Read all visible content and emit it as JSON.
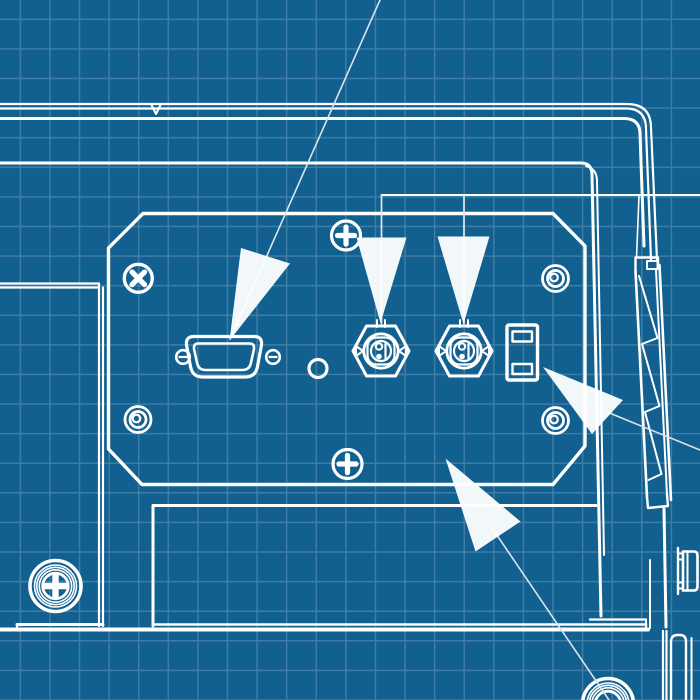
{
  "diagram": {
    "kind": "blueprint-rear-panel-drawing",
    "text_content": "",
    "callout_arrow_count": 5
  },
  "colors": {
    "background": "#11608F",
    "grid": "#3E7DA5",
    "line": "#FFFFFF",
    "arrow": "#FFFFFF",
    "callout": "#D9E4EC"
  },
  "grid": {
    "spacing_px": 29.6,
    "offset_x": 19.6,
    "offset_y": 18.6,
    "line_width_px": 1.7
  },
  "components": {
    "names": [
      "device-outline",
      "rear-io-panel",
      "dsub-connector",
      "bnc-connector-left",
      "bnc-connector-right",
      "slide-switch",
      "x-slot-screw",
      "phillips-screw-top",
      "phillips-screw-bottom",
      "rivet-left",
      "rivet-top-right",
      "rivet-bottom-right",
      "panel-hole",
      "side-hinge-bracket",
      "chassis-screw-bottom-left",
      "chassis-screw-bottom-right",
      "callout-arrow-dsub",
      "callout-arrow-bnc-left",
      "callout-arrow-bnc-right",
      "callout-arrow-switch",
      "callout-arrow-recess"
    ]
  }
}
